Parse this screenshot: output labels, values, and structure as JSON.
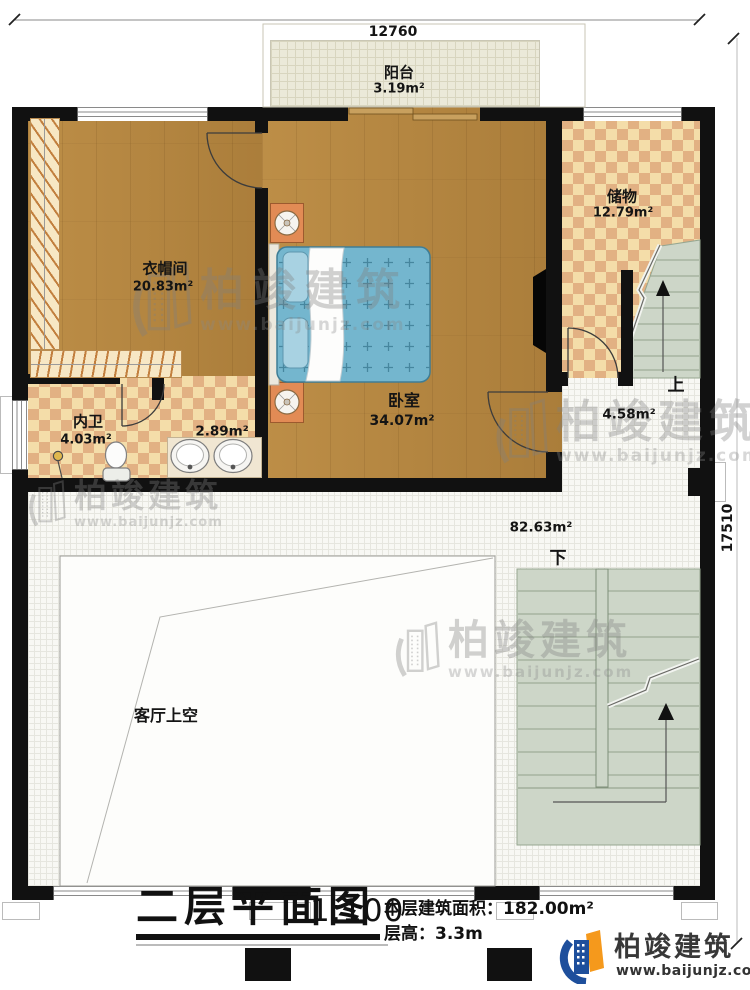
{
  "plan": {
    "dimensions": {
      "top": "12760",
      "right": "17510"
    },
    "rooms": {
      "balcony": {
        "name": "阳台",
        "area": "3.19m²"
      },
      "storage": {
        "name": "储物",
        "area": "12.79m²"
      },
      "cloakroom": {
        "name": "衣帽间",
        "area": "20.83m²"
      },
      "bedroom": {
        "name": "卧室",
        "area": "34.07m²"
      },
      "bathroom": {
        "name": "内卫",
        "area": "4.03m²"
      },
      "wash_area": {
        "area": "2.89m²"
      },
      "stair_hall": {
        "area": "4.58m²"
      },
      "hall": {
        "area": "82.63m²"
      },
      "living_void": {
        "name": "客厅上空"
      }
    },
    "stairs": {
      "up_label": "上",
      "down_label": "下"
    }
  },
  "title_block": {
    "title": "二层平面图",
    "scale": "1:100",
    "floor_area_label": "本层建筑面积：",
    "floor_area_value": "182.00m²",
    "floor_height_label": "层高：",
    "floor_height_value": "3.3m"
  },
  "brand": {
    "name": "柏竣建筑",
    "website": "www.baijunjz.com,"
  },
  "watermark": {
    "name": "柏竣建筑",
    "website": "www.baijunjz.com"
  },
  "colors": {
    "wall": "#111111",
    "wood": "#b5853e",
    "tile_light": "#f4dda9",
    "tile_dark": "#e2b183",
    "stair": "#cdd6c8",
    "bed": "#74b6ce",
    "logo_blue": "#1e4f9c",
    "logo_orange": "#f5991c"
  }
}
